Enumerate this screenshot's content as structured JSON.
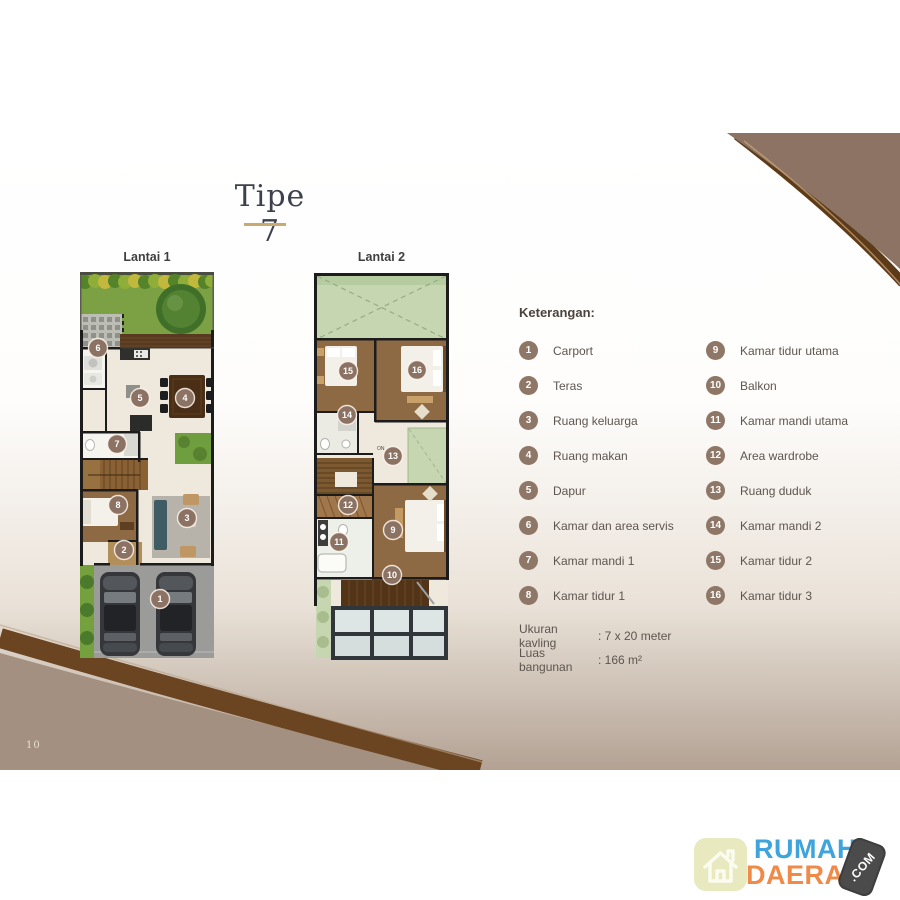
{
  "page": {
    "number": "10"
  },
  "title": {
    "text": "Tipe 7"
  },
  "plans": [
    {
      "label": "Lantai 1",
      "markers": [
        {
          "n": "6",
          "x": 18,
          "y": 76
        },
        {
          "n": "5",
          "x": 60,
          "y": 126
        },
        {
          "n": "4",
          "x": 105,
          "y": 126
        },
        {
          "n": "7",
          "x": 37,
          "y": 172
        },
        {
          "n": "8",
          "x": 38,
          "y": 233
        },
        {
          "n": "3",
          "x": 107,
          "y": 246
        },
        {
          "n": "2",
          "x": 44,
          "y": 278
        },
        {
          "n": "1",
          "x": 80,
          "y": 327
        }
      ]
    },
    {
      "label": "Lantai 2",
      "stairs_label": "ON",
      "markers": [
        {
          "n": "15",
          "x": 35,
          "y": 99
        },
        {
          "n": "16",
          "x": 104,
          "y": 98
        },
        {
          "n": "14",
          "x": 34,
          "y": 143
        },
        {
          "n": "13",
          "x": 80,
          "y": 184
        },
        {
          "n": "12",
          "x": 35,
          "y": 233
        },
        {
          "n": "9",
          "x": 80,
          "y": 258
        },
        {
          "n": "11",
          "x": 26,
          "y": 270
        },
        {
          "n": "10",
          "x": 79,
          "y": 303
        }
      ]
    }
  ],
  "legend": {
    "heading": "Keterangan:",
    "left": [
      {
        "num": "1",
        "label": "Carport"
      },
      {
        "num": "2",
        "label": "Teras"
      },
      {
        "num": "3",
        "label": "Ruang keluarga"
      },
      {
        "num": "4",
        "label": "Ruang makan"
      },
      {
        "num": "5",
        "label": "Dapur"
      },
      {
        "num": "6",
        "label": "Kamar dan area servis"
      },
      {
        "num": "7",
        "label": "Kamar mandi 1"
      },
      {
        "num": "8",
        "label": "Kamar tidur 1"
      }
    ],
    "right": [
      {
        "num": "9",
        "label": "Kamar tidur utama"
      },
      {
        "num": "10",
        "label": "Balkon"
      },
      {
        "num": "11",
        "label": "Kamar mandi utama"
      },
      {
        "num": "12",
        "label": "Area wardrobe"
      },
      {
        "num": "13",
        "label": "Ruang duduk"
      },
      {
        "num": "14",
        "label": "Kamar mandi 2"
      },
      {
        "num": "15",
        "label": "Kamar tidur 2"
      },
      {
        "num": "16",
        "label": "Kamar tidur 3"
      }
    ]
  },
  "specs": [
    {
      "label": "Ukuran kavling",
      "value": ": 7 x 20 meter"
    },
    {
      "label": "Luas bangunan",
      "value": ": 166 m²"
    }
  ],
  "logo": {
    "word1": "RUMAH",
    "word2": "DAERAH",
    "badge": ".COM"
  },
  "colors": {
    "accent_underline": "#c9a96e",
    "legend_badge": "#8f7767",
    "marker_circle": "#8b7262",
    "logo_blue": "#3fa4dc",
    "logo_orange": "#f08a49",
    "swoosh_taupe": "#8c7363",
    "swoosh_dark": "#5e3b18"
  }
}
